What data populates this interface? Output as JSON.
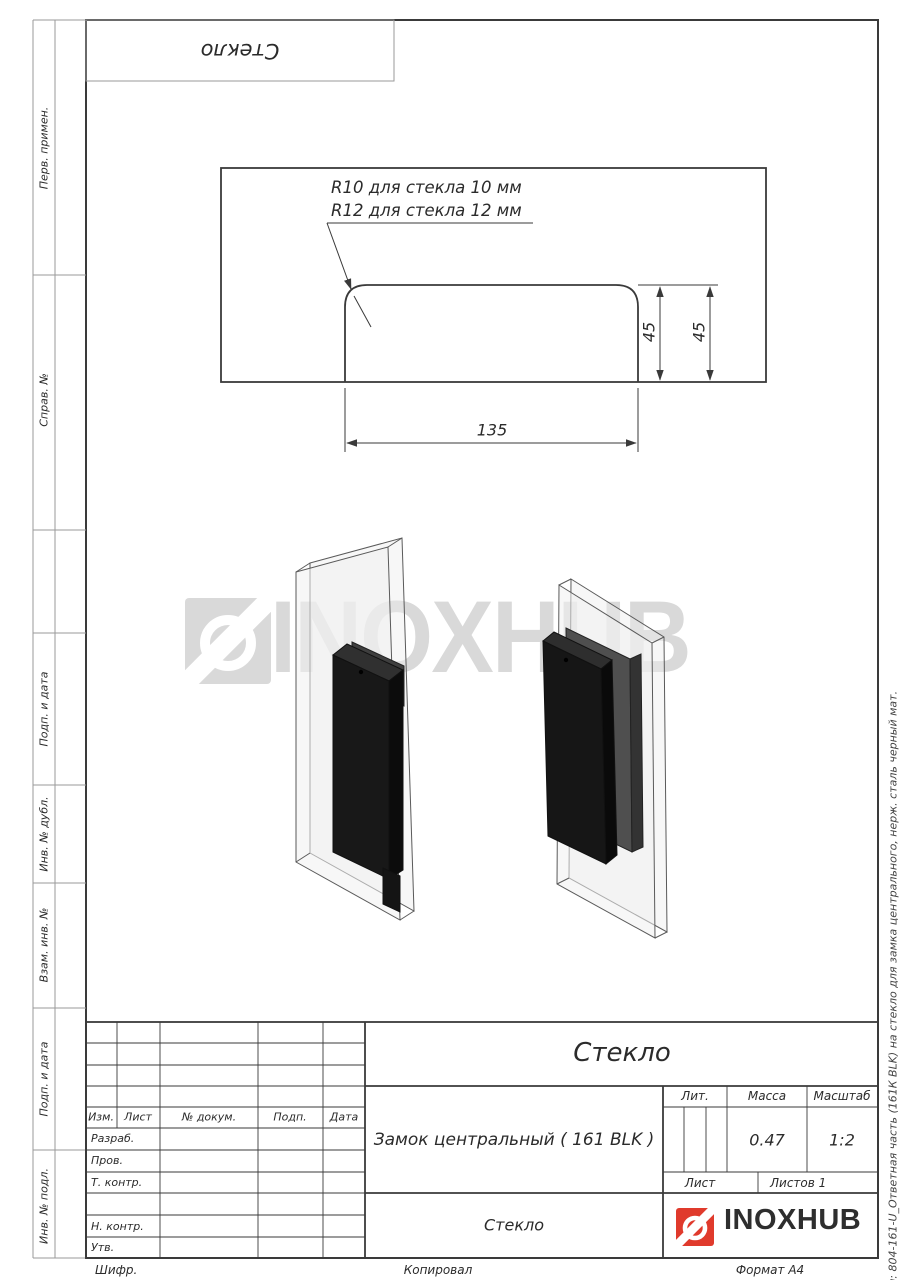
{
  "top_stamp": {
    "designation": "Стекло"
  },
  "side_left": {
    "labels": [
      "Перв. примен.",
      "Справ. №",
      "Подп. и дата",
      "Инв. № дубл.",
      "Взам. инв. №",
      "Подп. и дата",
      "Инв. № подл."
    ]
  },
  "side_right": {
    "file_note": "Файл: 804-161-U_Ответная часть (161К BLK) на стекло для замка центрального, нерж. сталь черный мат."
  },
  "drawing": {
    "callout_line1": "R10 для стекла 10 мм",
    "callout_line2": "R12 для стекла 12 мм",
    "dims": {
      "height_inner": "45",
      "height_outer": "45",
      "width": "135"
    }
  },
  "watermark": {
    "text": "INOXHUB"
  },
  "title_block": {
    "header": {
      "izm": "Изм.",
      "list": "Лист",
      "doc": "№ докум.",
      "podp": "Подп.",
      "data": "Дата"
    },
    "rows": [
      "Разраб.",
      "Пров.",
      "Т. контр.",
      "Н. контр.",
      "Утв."
    ],
    "designation": "Стекло",
    "name": "Замок центральный ( 161 BLK )",
    "lit_label": "Лит.",
    "mass_label": "Масса",
    "scale_label": "Масштаб",
    "mass_value": "0.47",
    "scale_value": "1:2",
    "sheet_label": "Лист",
    "sheets_label": "Листов 1",
    "material": "Стекло",
    "logo_text": "INOXHUB"
  },
  "footer": {
    "cipher": "Шифр.",
    "copied": "Копировал",
    "format": "Формат A4"
  },
  "colors": {
    "accent_red": "#E03A2C",
    "watermark_gray": "#D9D9D9",
    "line_dark": "#3a3a3a",
    "line_light": "#9a9a9a"
  }
}
